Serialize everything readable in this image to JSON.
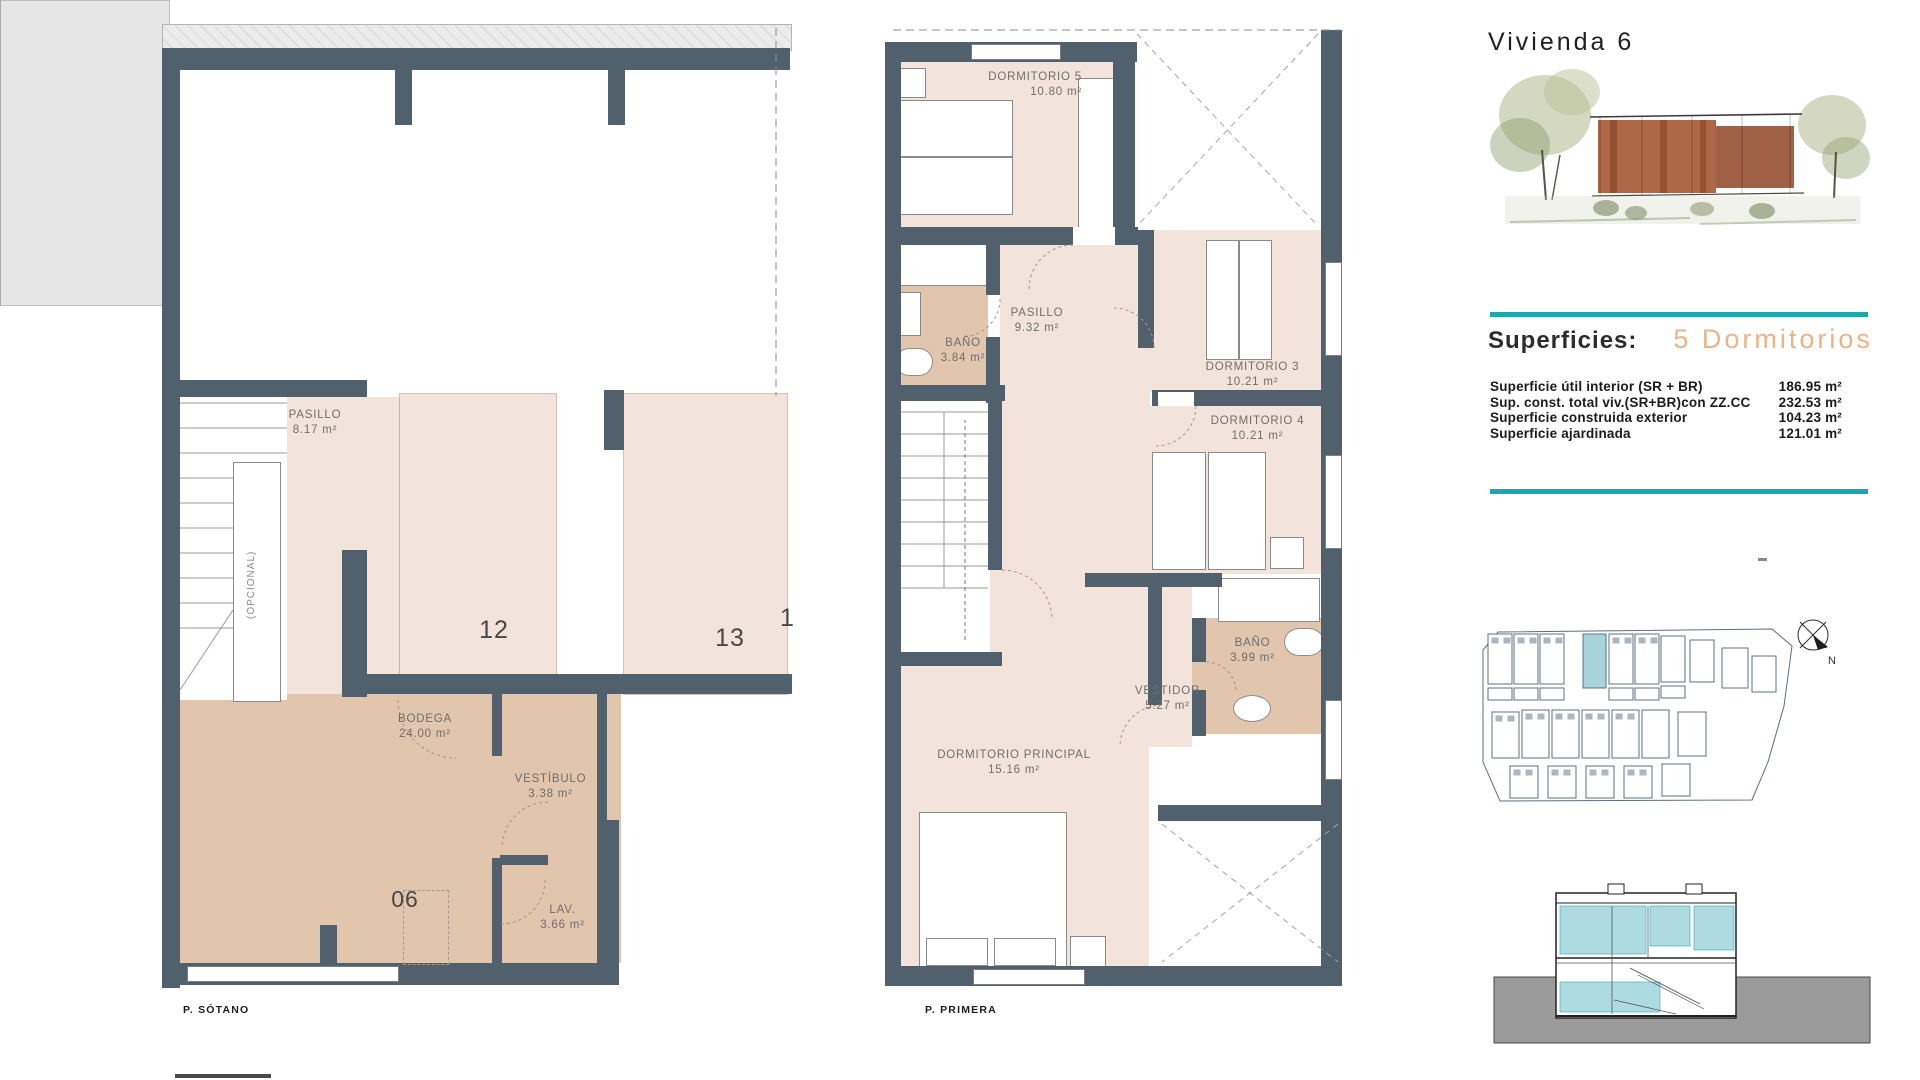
{
  "panel": {
    "title": "Vivienda 6",
    "superficies_label": "Superficies:",
    "bedrooms_label": "5 Dormitorios",
    "measurements": [
      {
        "label": "Superficie útil interior (SR + BR)",
        "value": "186.95 m²"
      },
      {
        "label": "Sup. const. total viv.(SR+BR)con ZZ.CC",
        "value": "232.53 m²"
      },
      {
        "label": "Superficie construida exterior",
        "value": "104.23 m²"
      },
      {
        "label": "Superficie ajardinada",
        "value": "121.01 m²"
      }
    ],
    "compass_n": "N"
  },
  "sotano": {
    "caption": "P. SÓTANO",
    "rooms": {
      "pasillo": {
        "name": "PASILLO",
        "area": "8.17 m²"
      },
      "bodega": {
        "name": "BODEGA",
        "area": "24.00 m²"
      },
      "vestibulo": {
        "name": "VESTÍBULO",
        "area": "3.38 m²"
      },
      "lav": {
        "name": "LAV.",
        "area": "3.66 m²"
      }
    },
    "parking": {
      "p12": "12",
      "p13": "13",
      "p_next": "1"
    },
    "storage_number": "06",
    "elevator_note": "(OPCIONAL)"
  },
  "primera": {
    "caption": "P. PRIMERA",
    "rooms": {
      "dorm5": {
        "name": "DORMITORIO 5",
        "area": "10.80 m²"
      },
      "bano1": {
        "name": "BAÑO",
        "area": "3.84 m²"
      },
      "pasillo": {
        "name": "PASILLO",
        "area": "9.32 m²"
      },
      "dorm3": {
        "name": "DORMITORIO 3",
        "area": "10.21 m²"
      },
      "dorm4": {
        "name": "DORMITORIO 4",
        "area": "10.21 m²"
      },
      "bano2": {
        "name": "BAÑO",
        "area": "3.99 m²"
      },
      "vestidor": {
        "name": "VESTIDOR",
        "area": "5.27 m²"
      },
      "principal": {
        "name": "DORMITORIO PRINCIPAL",
        "area": "15.16 m²"
      }
    }
  },
  "colors": {
    "accent_teal": "#1ba7ac",
    "wall": "#50606c",
    "floor_light": "#f2e4da",
    "floor_tan": "#e2c5ad",
    "site_highlight": "#a6d3dc",
    "bedrooms_text": "#eab388"
  }
}
